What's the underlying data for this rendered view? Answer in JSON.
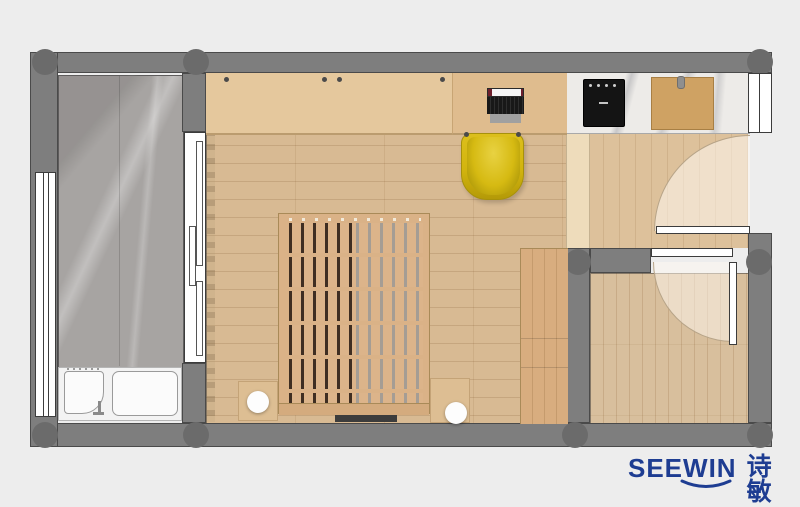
{
  "brand": {
    "name_en": "SEEWIN",
    "name_zh": "诗敏",
    "color": "#1e3d92"
  },
  "palette": {
    "background": "#ededed",
    "wall_gray": "#7e7e7e",
    "column_gray": "#6b6b6b",
    "balcony_marble": "#a7a4a2",
    "kitchen_marble": "#edebe8",
    "main_floor_wood": "#d8ba93",
    "hall_wood": "#ddc19b",
    "small_room_wood": "#d8bf9d",
    "platform_wood": "#d8ad7f",
    "wardrobe_wood": "#e5c89d",
    "bed_wood": "#dab287",
    "chair_yellow": "#d6ba12",
    "cooktop_black": "#141414",
    "fixture_white": "#ffffff"
  },
  "plan": {
    "type": "apartment-floor-plan-top-view",
    "rooms": [
      {
        "id": "balcony",
        "floor": "gray-marble",
        "fixtures": [
          "window",
          "sliding-door",
          "bathtub"
        ]
      },
      {
        "id": "main-room",
        "floor": "wood-plank",
        "fixtures": [
          "wardrobe-counter",
          "desk",
          "laptop",
          "chair",
          "slatted-bed",
          "side-stools",
          "platform"
        ]
      },
      {
        "id": "kitchenette",
        "floor": "white-marble-counter",
        "fixtures": [
          "cooktop",
          "cutting-board"
        ]
      },
      {
        "id": "entry-hall",
        "floor": "wood-plank",
        "fixtures": [
          "entry-door"
        ]
      },
      {
        "id": "small-room",
        "floor": "wood-plank",
        "fixtures": [
          "interior-door"
        ]
      }
    ]
  }
}
